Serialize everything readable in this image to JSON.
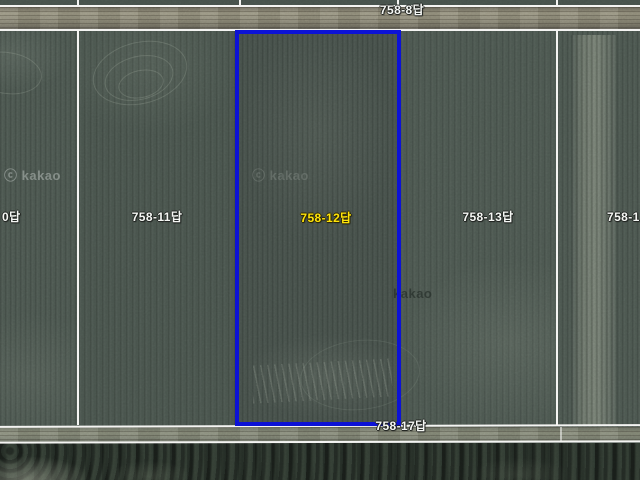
{
  "map": {
    "view": "satellite-cadastral",
    "selected_parcel": {
      "label": "758-12답",
      "outline_color": "#0c12d6",
      "label_color": "#ffe40a"
    },
    "labels": [
      {
        "id": "top-road-parcel",
        "text": "758-8답"
      },
      {
        "id": "left-edge-partial",
        "text": "0답"
      },
      {
        "id": "parcel-11",
        "text": "758-11답"
      },
      {
        "id": "parcel-12-selected",
        "text": "758-12답"
      },
      {
        "id": "parcel-13",
        "text": "758-13답"
      },
      {
        "id": "right-edge-partial",
        "text": "758-1"
      },
      {
        "id": "bottom-road-parcel",
        "text": "758-17답"
      }
    ],
    "watermarks": [
      {
        "text": "ⓒ kakao"
      },
      {
        "text": "ⓒ kakao"
      },
      {
        "text": "kakao"
      }
    ],
    "colors": {
      "field": "#46514b",
      "road": "#8d8a78",
      "boundary_line": "#f4f4f2",
      "tree_band": "#2c362e",
      "label_text": "#f5f7f4"
    }
  }
}
